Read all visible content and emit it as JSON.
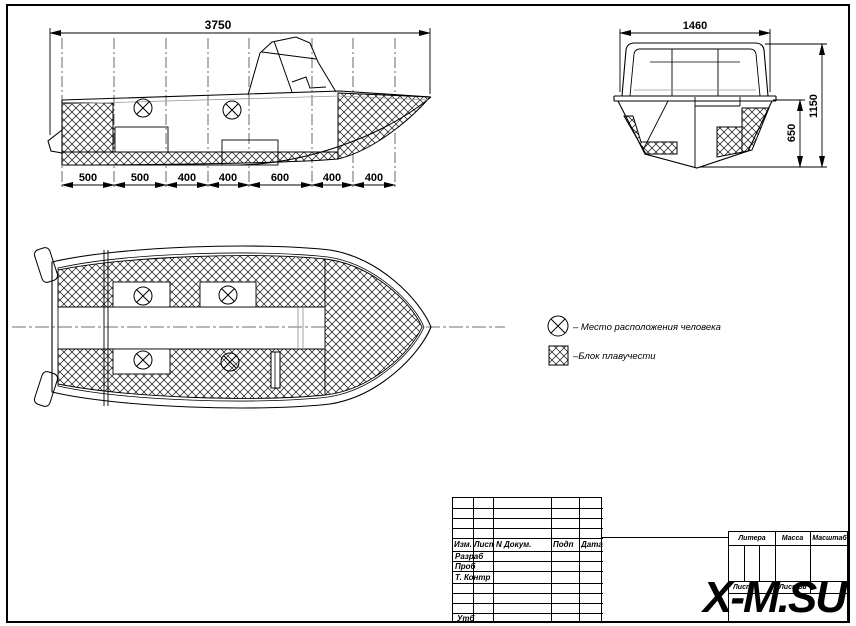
{
  "page": {
    "watermark": "X-M.SU",
    "background_color": "#ffffff",
    "line_color": "#000000"
  },
  "side_view": {
    "overall_dim": "3750",
    "segment_dims": [
      "500",
      "500",
      "400",
      "400",
      "600",
      "400",
      "400"
    ]
  },
  "transom_view": {
    "width_dim": "1460",
    "height_dim": "1150",
    "inner_height_dim": "650"
  },
  "legend": {
    "person": {
      "symbol": "circle-x-icon",
      "label": "– Место расположения человека"
    },
    "buoyancy": {
      "symbol": "hatch-square-icon",
      "label": "–Блок плавучести"
    }
  },
  "title_block": {
    "header": {
      "izm": "Изм.",
      "list": "Лист",
      "n_dokum": "N Докум.",
      "podp": "Подп",
      "data": "Дата"
    },
    "rows": [
      "Разраб",
      "Проб",
      "Т. Контр",
      "Утб"
    ],
    "right": {
      "litera": "Литера",
      "massa": "Масса",
      "masshtab": "Масштаб",
      "list": "Лист",
      "listov": "Листов"
    }
  }
}
